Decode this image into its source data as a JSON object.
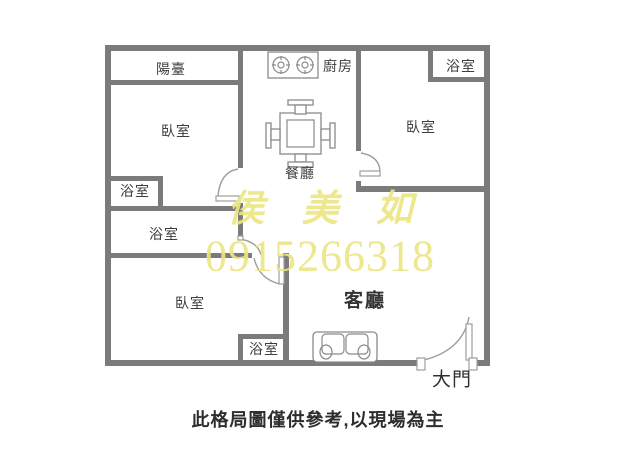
{
  "colors": {
    "wall": "#7b7b7b",
    "door": "#9e9e9e",
    "furniture": "#8a8a8a",
    "label": "#3e3e3e",
    "watermark": "#ece584",
    "disclaimer": "#2d2d2d"
  },
  "rooms": {
    "balcony": "陽臺",
    "kitchen": "廚房",
    "dining_room": "餐廳",
    "living_room": "客廳",
    "bedroom": "臥室",
    "bathroom": "浴室"
  },
  "main_door": {
    "label": "大門"
  },
  "watermark": {
    "agent_name": "侯 美 如",
    "phone": "0915266318"
  },
  "disclaimer": "此格局圖僅供參考,以現場為主"
}
